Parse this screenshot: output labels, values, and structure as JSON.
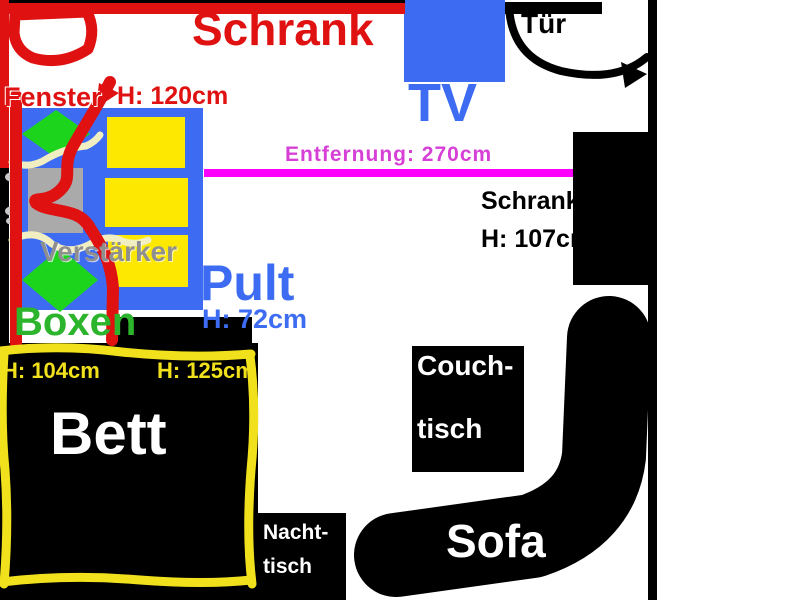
{
  "type": "hand-drawn-room-floorplan",
  "labels": {
    "wardrobe_top": "Schrank",
    "tv": "TV",
    "door": "Tür",
    "window": "Fenster",
    "window_height": "H: 120cm",
    "distance": "Entfernung: 270cm",
    "wardrobe_right": "Schrank",
    "wardrobe_right_height": "H: 107cm",
    "amplifier": "Verstärker",
    "desk": "Pult",
    "desk_height": "H: 72cm",
    "speakers": "Boxen",
    "bed": "Bett",
    "bed_height_left": "H: 104cm",
    "bed_height_right": "H: 125cm",
    "coffee_table_line1": "Couch-",
    "coffee_table_line2": "tisch",
    "nightstand_line1": "Nacht-",
    "nightstand_line2": "tisch",
    "sofa": "Sofa"
  },
  "colors": {
    "red_outline": "#df1111",
    "blue_furniture": "#3d6cf2",
    "yellow_blocks": "#fce800",
    "bed_border_yellow": "#f0e11c",
    "speaker_green": "#1dd41d",
    "boxen_text_green": "#2cb42c",
    "amplifier_gray": "#aaaaaa",
    "amplifier_text_gray": "#8f8f8f",
    "distance_line_magenta": "#ff00ff",
    "distance_text_magenta": "#d640d6",
    "cable_cream": "#f1eec2",
    "black_furniture": "#000000"
  }
}
